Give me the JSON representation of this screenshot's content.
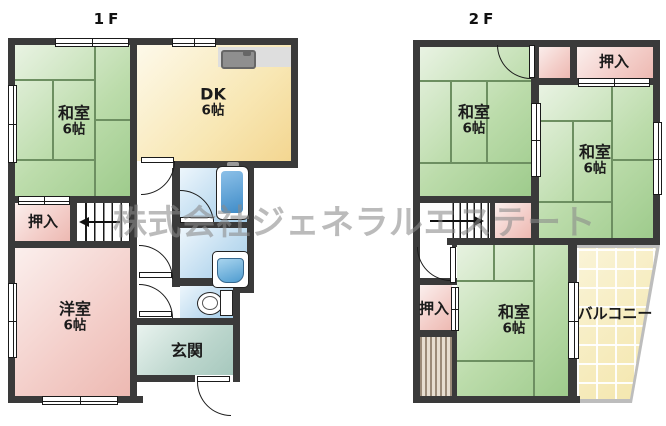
{
  "watermark": "株式会社ジェネラルエステート",
  "floor1": {
    "title": "1F",
    "rooms": {
      "washitsu": {
        "name": "和室",
        "size": "6帖"
      },
      "dk": {
        "name": "DK",
        "size": "6帖"
      },
      "oshiire": {
        "name": "押入"
      },
      "youshitsu": {
        "name": "洋室",
        "size": "6帖"
      },
      "genkan": {
        "name": "玄関"
      }
    }
  },
  "floor2": {
    "title": "2F",
    "rooms": {
      "washitsu_nw": {
        "name": "和室",
        "size": "6帖"
      },
      "washitsu_e": {
        "name": "和室",
        "size": "6帖"
      },
      "washitsu_s": {
        "name": "和室",
        "size": "6帖"
      },
      "oshiire_n": {
        "name": "押入"
      },
      "oshiire_w": {
        "name": "押入"
      },
      "balcony": {
        "name": "バルコニー"
      }
    }
  },
  "fixtures": [
    "kitchen-sink",
    "bathtub",
    "washbasin",
    "toilet",
    "stairs-down",
    "stairs-up",
    "entry-door"
  ],
  "colors": {
    "wall": "#3a3a3a",
    "tatami_room": "#b0d6a0",
    "western_room": "#f0c6c0",
    "dining_kitchen": "#f6dfa2",
    "wet_area": "#b4d8ef",
    "entrance": "#b0cec4",
    "balcony": "#f5eab5",
    "watermark": "#8b8b8b"
  }
}
